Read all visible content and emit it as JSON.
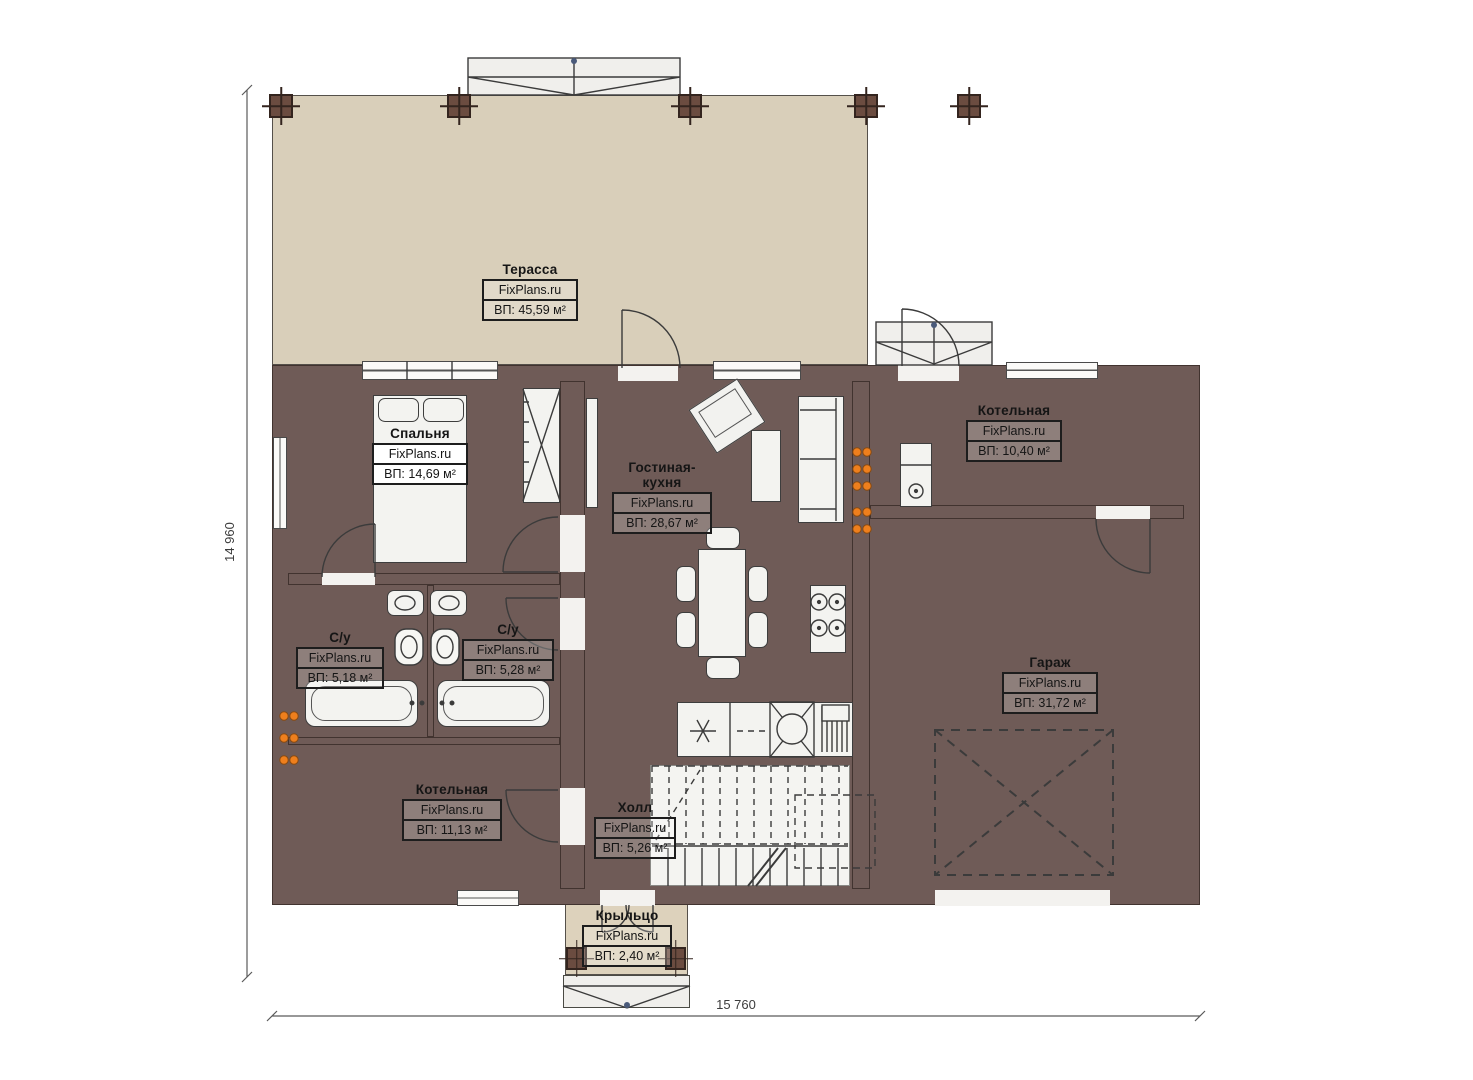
{
  "brand": "FixPlans.ru",
  "dims": {
    "height": "14 960",
    "width": "15 760"
  },
  "rooms": {
    "terrace": {
      "name": "Терасса",
      "brand": "FixPlans.ru",
      "area": "ВП: 45,59 м²"
    },
    "bedroom": {
      "name": "Спальня",
      "brand": "FixPlans.ru",
      "area": "ВП: 14,69 м²"
    },
    "living": {
      "name": "Гостиная-кухня",
      "brand": "FixPlans.ru",
      "area": "ВП: 28,67 м²"
    },
    "boiler_top": {
      "name": "Котельная",
      "brand": "FixPlans.ru",
      "area": "ВП: 10,40 м²"
    },
    "bath_left": {
      "name": "С/у",
      "brand": "FixPlans.ru",
      "area": "ВП: 5,18 м²"
    },
    "bath_right": {
      "name": "С/у",
      "brand": "FixPlans.ru",
      "area": "ВП: 5,28 м²"
    },
    "garage": {
      "name": "Гараж",
      "brand": "FixPlans.ru",
      "area": "ВП: 31,72 м²"
    },
    "boiler_bottom": {
      "name": "Котельная",
      "brand": "FixPlans.ru",
      "area": "ВП: 11,13 м²"
    },
    "hall": {
      "name": "Холл",
      "brand": "FixPlans.ru",
      "area": "ВП: 5,26 м²"
    },
    "porch": {
      "name": "Крыльцо",
      "brand": "FixPlans.ru",
      "area": "ВП: 2,40 м²"
    }
  },
  "colors": {
    "wall": "#6F5B57",
    "terrace_floor": "#D9CFBA",
    "bedroom_floor": "#7F6C54",
    "bath_tile": "#B5D6F0",
    "gray_tile": "#DCDCDC",
    "tan_tile": "#D6C095",
    "radiator_dot": "#EE7F1D"
  }
}
